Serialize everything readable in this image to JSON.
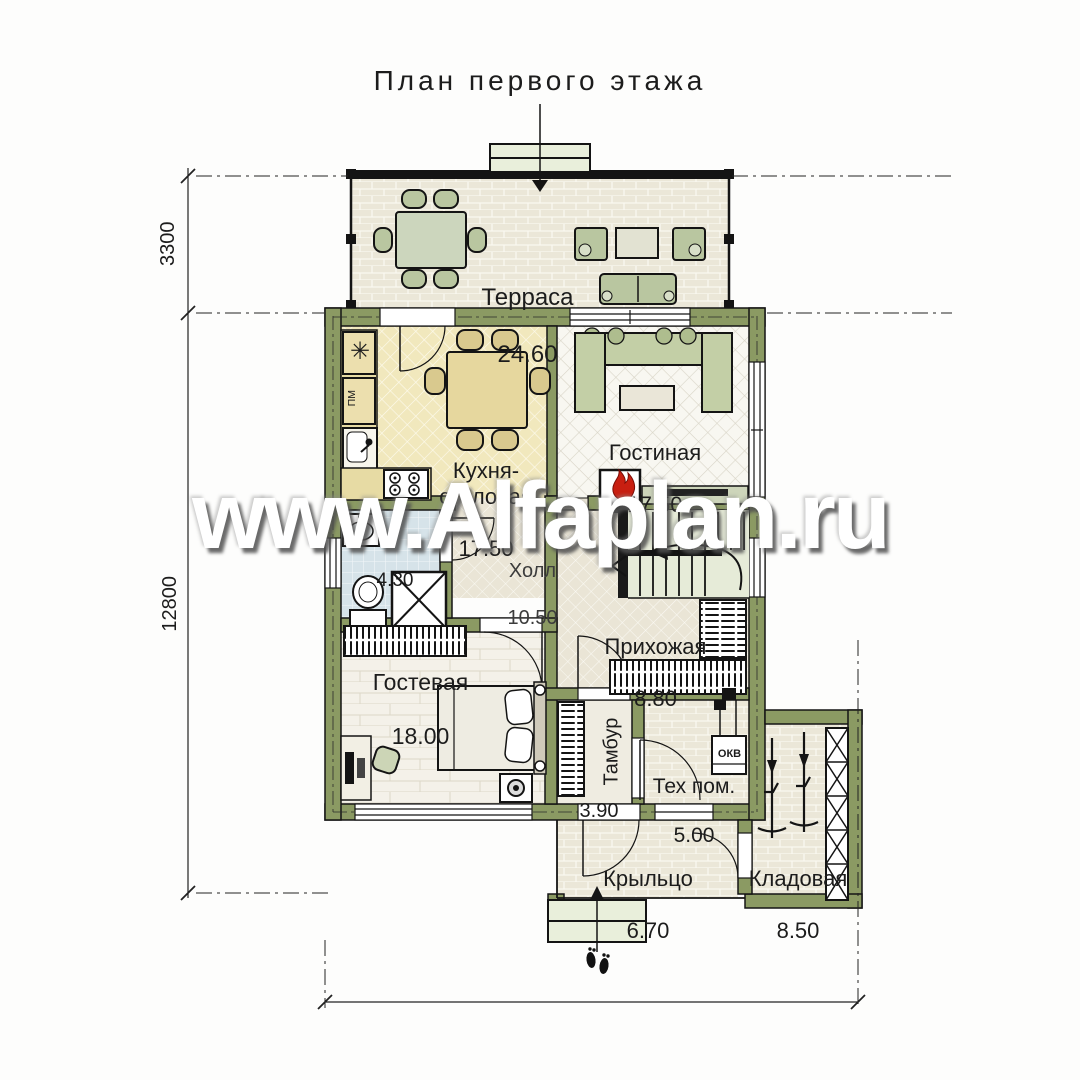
{
  "title": "План первого этажа",
  "watermark": "www.Alfaplan.ru",
  "dimensions": {
    "terrace_depth": "3300",
    "house_length": "12800",
    "house_width": "11700"
  },
  "rooms": [
    {
      "name": "Терраса",
      "area": "24.60"
    },
    {
      "name": "Кухня-столовая",
      "area": "17.50"
    },
    {
      "name": "Гостиная",
      "area": "17.50"
    },
    {
      "name": "Холл",
      "area": "10.50"
    },
    {
      "name": "",
      "area": "4.30"
    },
    {
      "name": "Гостевая",
      "area": "18.00"
    },
    {
      "name": "Прихожая",
      "area": "8.80"
    },
    {
      "name": "Тамбур",
      "area": "3.90"
    },
    {
      "name": "Тех пом.",
      "area": "5.00"
    },
    {
      "name": "Крыльцо",
      "area": "6.70"
    },
    {
      "name": "Кладовая",
      "area": "8.50"
    }
  ],
  "equipment": {
    "dishwasher": "ПМ",
    "boiler": "ОКВ",
    "fridge_icon": "✳"
  },
  "colors": {
    "wall": "#8b9a63",
    "flame": "#c81f11",
    "stairs_bg": "#e6ebd8"
  }
}
